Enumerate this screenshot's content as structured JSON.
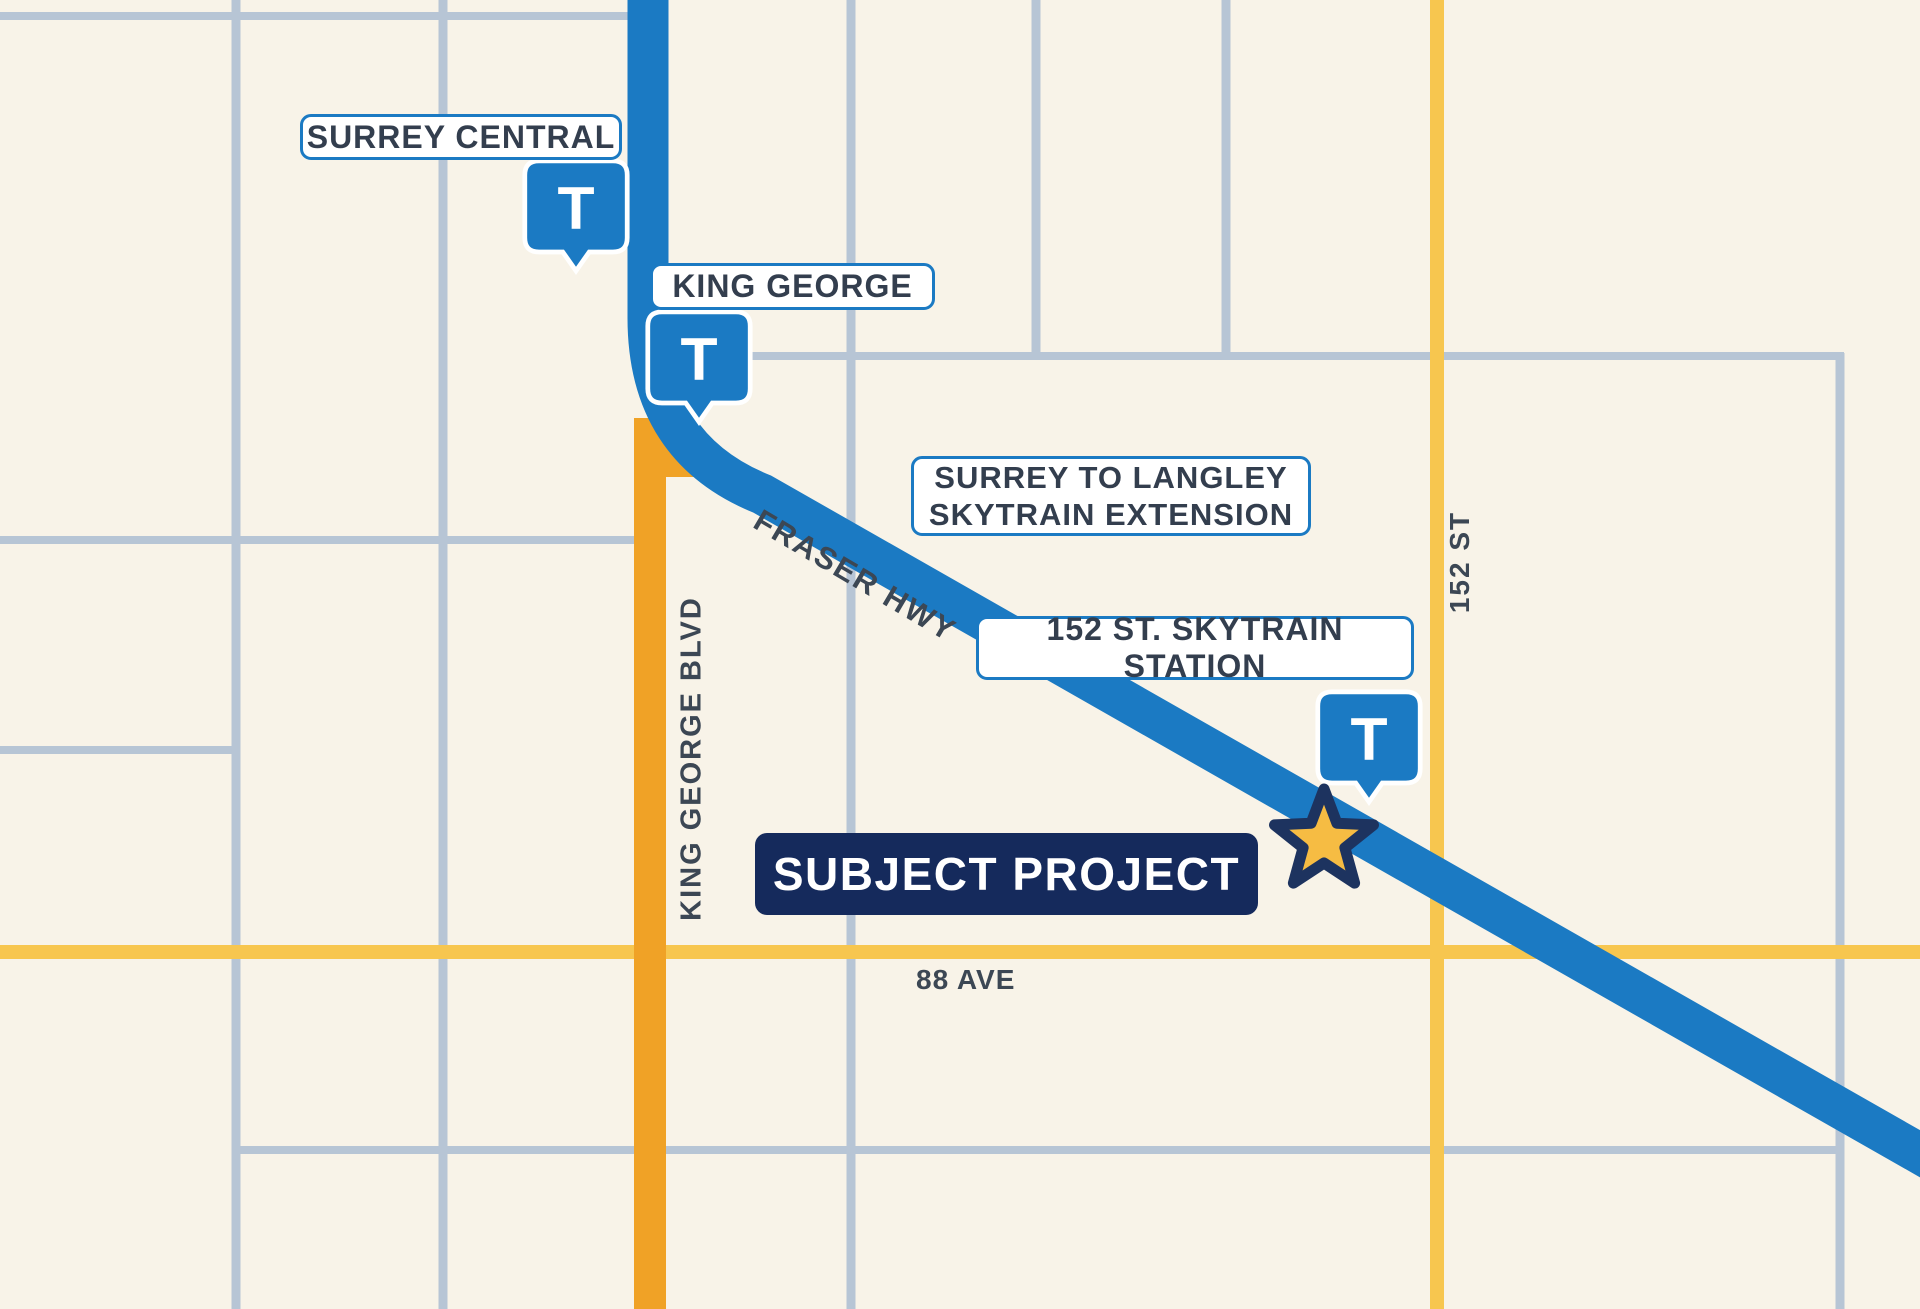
{
  "map": {
    "title": "Surrey to Langley SkyTrain extension location map",
    "colors": {
      "background_cream": "#f8f3e8",
      "grid_line": "#b7c5d5",
      "skytrain_blue": "#1b7ac3",
      "road_orange": "#f0a226",
      "road_yellow": "#f7c64f",
      "navy": "#152a5c",
      "star_gold": "#f6bc43",
      "label_text": "#333e4e",
      "street_text": "#3c4754"
    },
    "stations": [
      {
        "id": "surrey-central",
        "label": "SURREY CENTRAL",
        "glyph": "T"
      },
      {
        "id": "king-george",
        "label": "KING GEORGE",
        "glyph": "T"
      },
      {
        "id": "152-st",
        "label": "152 ST. SKYTRAIN STATION",
        "glyph": "T"
      }
    ],
    "line_label": {
      "line1": "SURREY TO LANGLEY",
      "line2": "SKYTRAIN EXTENSION"
    },
    "subject": {
      "label": "SUBJECT PROJECT"
    },
    "streets": {
      "fraser": "FRASER HWY",
      "kgblvd": "KING GEORGE BLVD",
      "ave88": "88 AVE",
      "st152": "152 ST"
    }
  }
}
